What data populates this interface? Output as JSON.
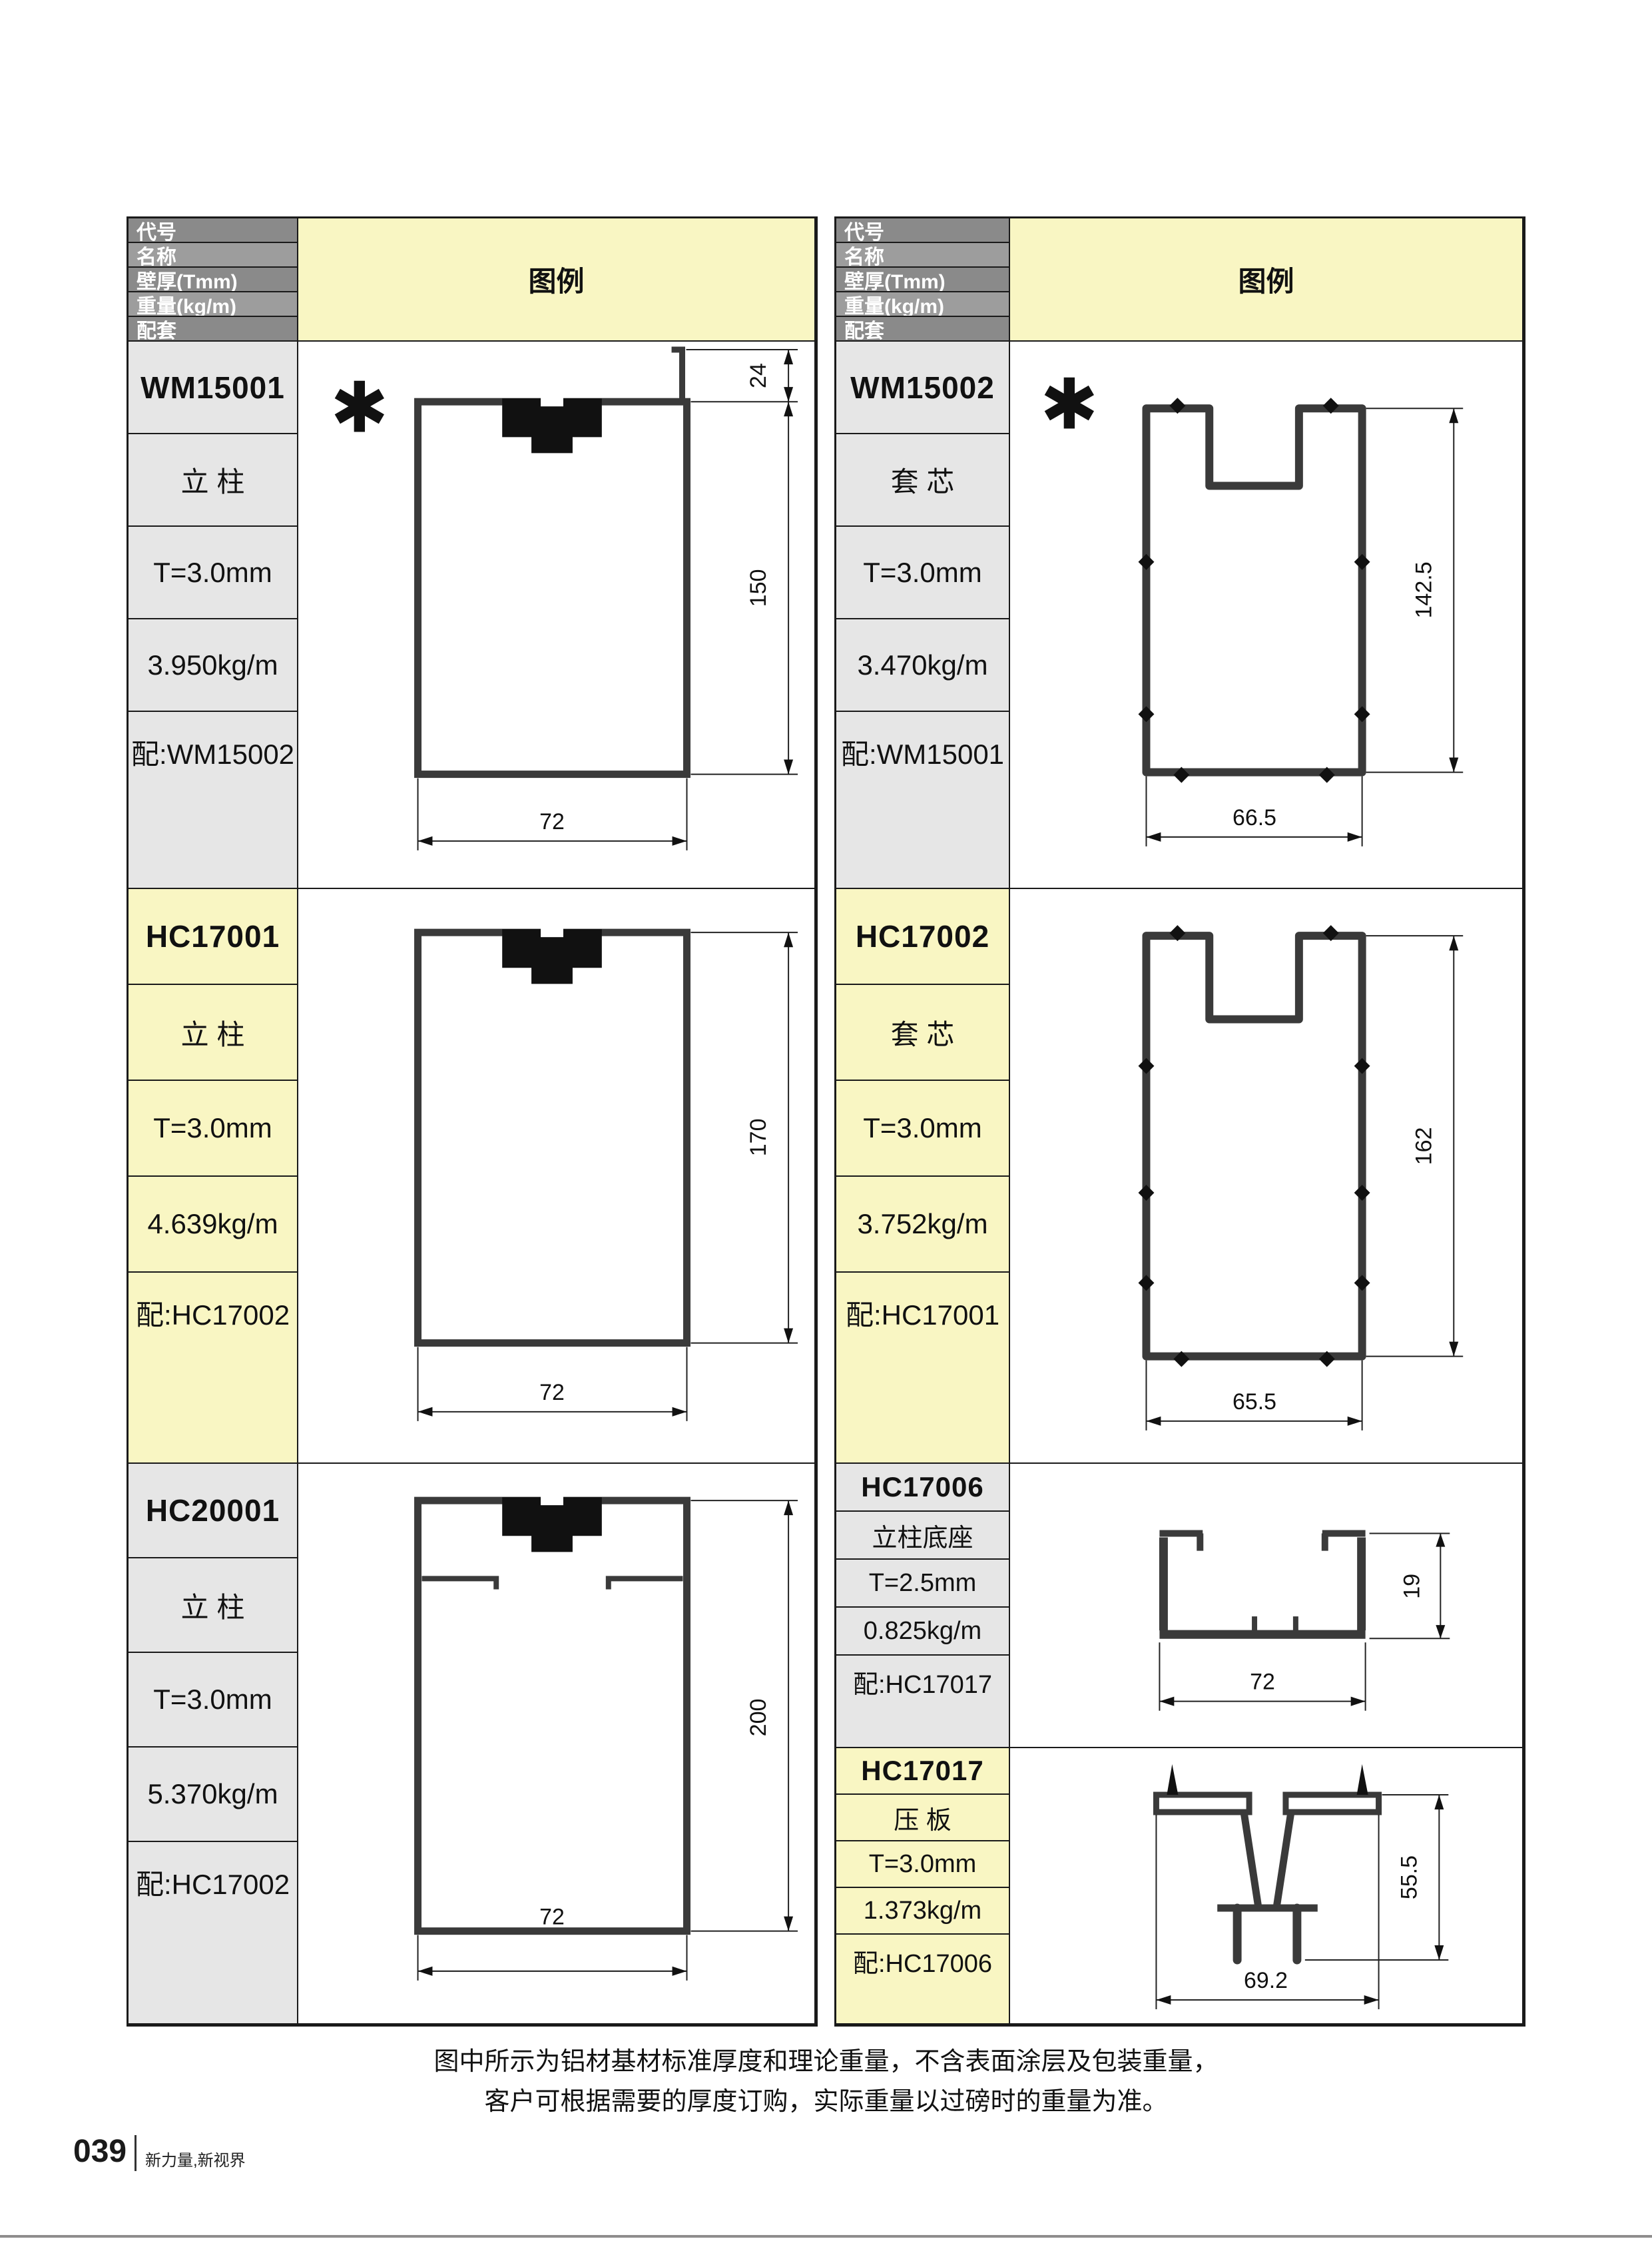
{
  "header": {
    "code": "代号",
    "name": "名称",
    "thickness": "壁厚(Tmm)",
    "weight": "重量(kg/m)",
    "match": "配套",
    "legend": "图例"
  },
  "star": "✱",
  "products": {
    "wm15001": {
      "code": "WM15001",
      "name": "立 柱",
      "thickness": "T=3.0mm",
      "weight": "3.950kg/m",
      "match": "配:WM15002",
      "dim_h": "150",
      "dim_w": "72",
      "dim_extra": "24"
    },
    "wm15002": {
      "code": "WM15002",
      "name": "套 芯",
      "thickness": "T=3.0mm",
      "weight": "3.470kg/m",
      "match": "配:WM15001",
      "dim_h": "142.5",
      "dim_w": "66.5"
    },
    "hc17001": {
      "code": "HC17001",
      "name": "立 柱",
      "thickness": "T=3.0mm",
      "weight": "4.639kg/m",
      "match": "配:HC17002",
      "dim_h": "170",
      "dim_w": "72"
    },
    "hc17002": {
      "code": "HC17002",
      "name": "套 芯",
      "thickness": "T=3.0mm",
      "weight": "3.752kg/m",
      "match": "配:HC17001",
      "dim_h": "162",
      "dim_w": "65.5"
    },
    "hc20001": {
      "code": "HC20001",
      "name": "立 柱",
      "thickness": "T=3.0mm",
      "weight": "5.370kg/m",
      "match": "配:HC17002",
      "dim_h": "200",
      "dim_w": "72"
    },
    "hc17006": {
      "code": "HC17006",
      "name": "立柱底座",
      "thickness": "T=2.5mm",
      "weight": "0.825kg/m",
      "match": "配:HC17017",
      "dim_h": "19",
      "dim_w": "72"
    },
    "hc17017": {
      "code": "HC17017",
      "name": "压 板",
      "thickness": "T=3.0mm",
      "weight": "1.373kg/m",
      "match": "配:HC17006",
      "dim_h": "55.5",
      "dim_w": "69.2"
    }
  },
  "note": {
    "line1": "图中所示为铝材基材标准厚度和理论重量，不含表面涂层及包装重量，",
    "line2": "客户可根据需要的厚度订购，实际重量以过磅时的重量为准。"
  },
  "footer": {
    "page": "039",
    "brand": "新力量,新视界"
  }
}
